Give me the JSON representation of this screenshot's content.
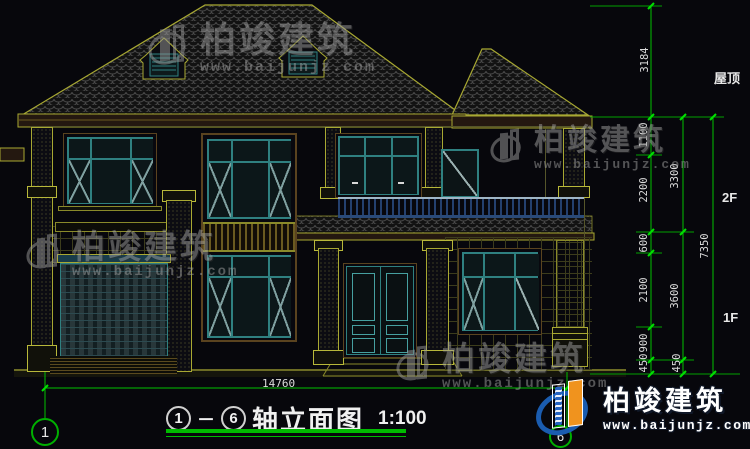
{
  "drawing": {
    "title": {
      "axis_start": "1",
      "axis_end": "6",
      "separator": "－",
      "name": "轴立面图",
      "scale": "1:100"
    },
    "bottom_dimension": "14760",
    "axis_bubbles": {
      "left": "1",
      "right": "6"
    },
    "levels": {
      "roof": "屋顶",
      "second_floor": "2F",
      "first_floor": "1F"
    },
    "dims_chain_inner": [
      "3184",
      "1100",
      "2200",
      "600",
      "2100",
      "900",
      "450"
    ],
    "dims_chain_middle": [
      "3300",
      "3600",
      "450"
    ],
    "dims_chain_outer": [
      "7350"
    ]
  },
  "watermark": {
    "brand": "柏竣建筑",
    "url": "www.baijunjz.com"
  },
  "logo": {
    "brand": "柏竣建筑",
    "url": "www.baijunjz.com"
  },
  "colors": {
    "background": "#07070c",
    "cad_yellow": "#a8a832",
    "window_teal": "#2f8080",
    "dimension_green": "#00c000",
    "text_white": "#e8e8e8",
    "watermark_gray": "#9a9a9a",
    "logo_blue": "#1a5cb0",
    "logo_orange": "#f0931e"
  }
}
